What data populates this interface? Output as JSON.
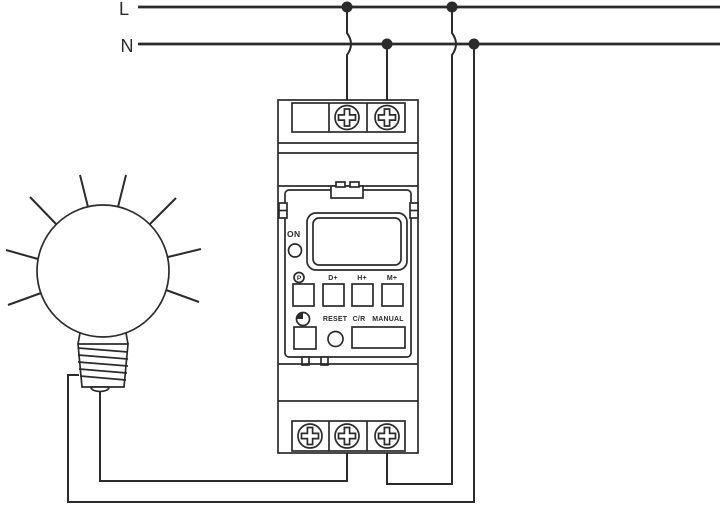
{
  "power": {
    "live_label": "L",
    "neutral_label": "N"
  },
  "timer": {
    "indicator_label": "ON",
    "buttons": {
      "program": "P",
      "day_plus": "D+",
      "hour_plus": "H+",
      "minute_plus": "M+",
      "reset": "RESET",
      "count_reset": "C/R",
      "manual": "MANUAL"
    }
  },
  "colors": {
    "stroke": "#2b2b2b",
    "background": "#ffffff"
  }
}
